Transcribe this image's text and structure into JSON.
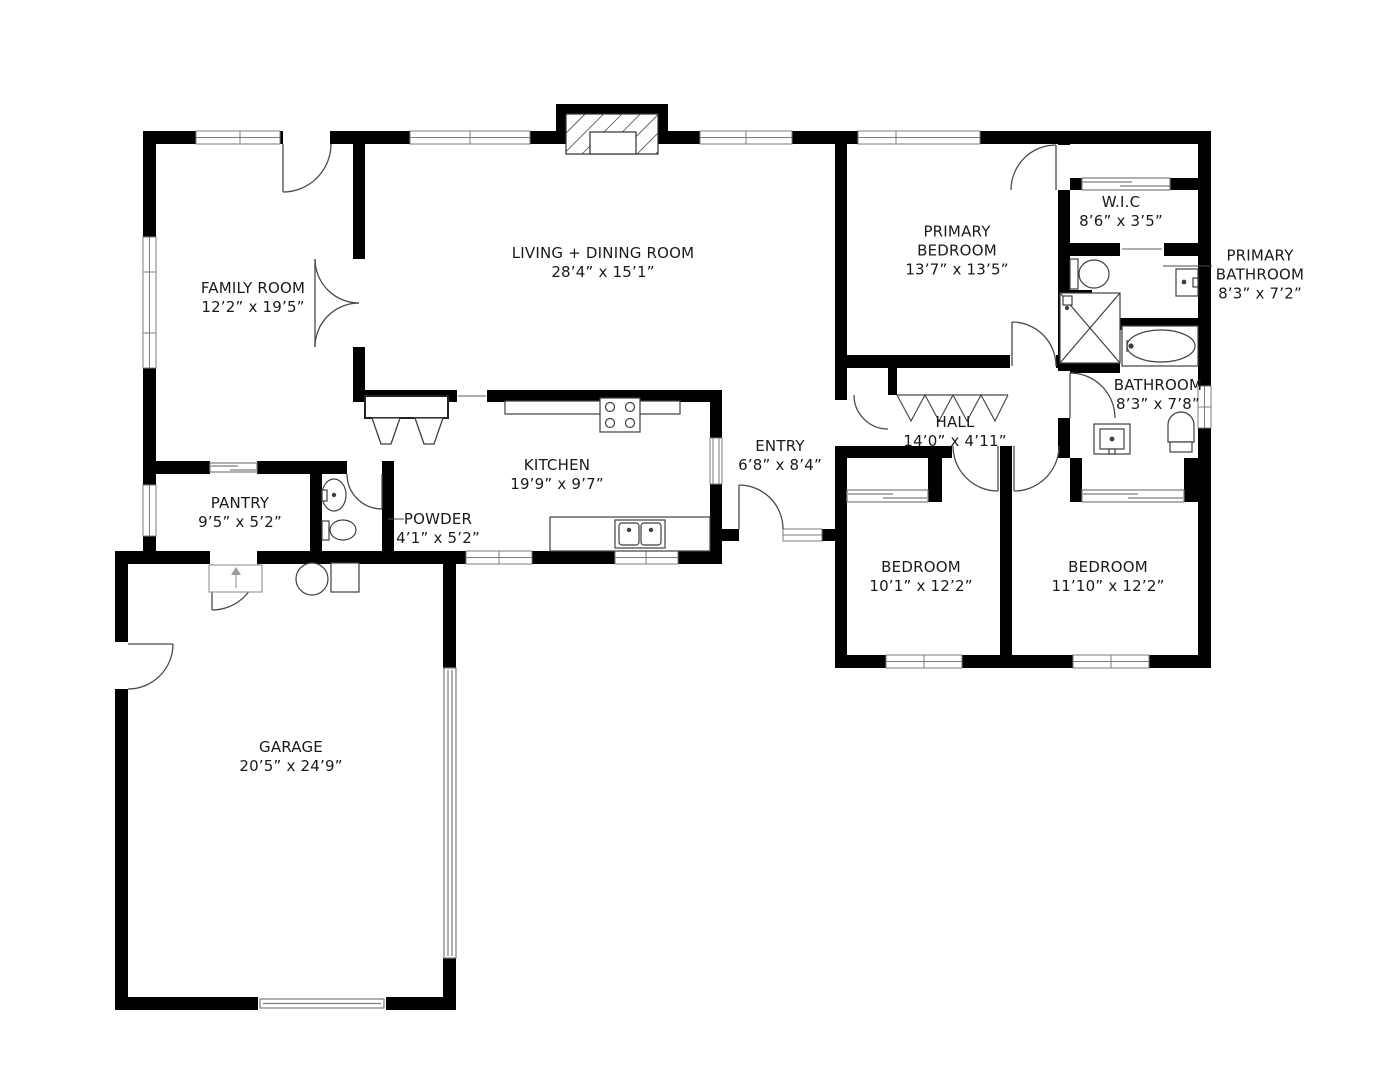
{
  "rooms": {
    "family_room": {
      "name": "FAMILY ROOM",
      "dims": "12’2” x 19’5”"
    },
    "living_dining": {
      "name": "LIVING + DINING ROOM",
      "dims": "28’4” x 15’1”"
    },
    "primary_bedroom": {
      "name": "PRIMARY BEDROOM",
      "dims": "13’7” x 13’5”"
    },
    "wic": {
      "name": "W.I.C",
      "dims": "8’6” x 3’5”"
    },
    "primary_bathroom": {
      "name": "PRIMARY BATHROOM",
      "dims": "8’3” x 7’2”"
    },
    "bathroom": {
      "name": "BATHROOM",
      "dims": "8’3” x 7’8”"
    },
    "hall": {
      "name": "HALL",
      "dims": "14’0” x 4’11”"
    },
    "entry": {
      "name": "ENTRY",
      "dims": "6’8” x 8’4”"
    },
    "kitchen": {
      "name": "KITCHEN",
      "dims": "19’9” x 9’7”"
    },
    "pantry": {
      "name": "PANTRY",
      "dims": "9’5” x 5’2”"
    },
    "powder": {
      "name": "POWDER",
      "dims": "4’1” x 5’2”"
    },
    "bedroom_left": {
      "name": "BEDROOM",
      "dims": "10’1” x 12’2”"
    },
    "bedroom_right": {
      "name": "BEDROOM",
      "dims": "11’10” x 12’2”"
    },
    "garage": {
      "name": "GARAGE",
      "dims": "20’5” x 24’9”"
    }
  },
  "colors": {
    "wall": "#000000",
    "fixture_line": "#3f3f3f",
    "window_line": "#7d7d7d",
    "text": "#1a1a1a"
  }
}
